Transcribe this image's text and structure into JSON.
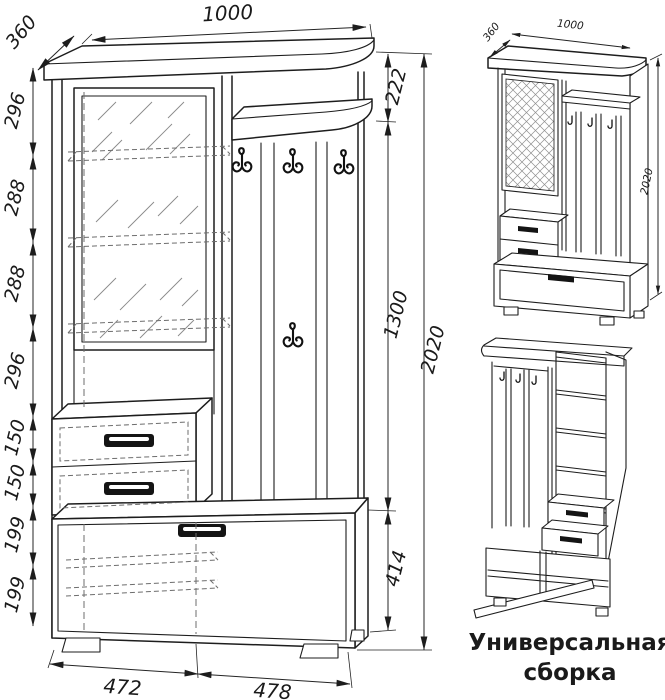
{
  "page": {
    "background": "#ffffff",
    "ink_color": "#1d1d1d"
  },
  "main_view": {
    "top_width_mm": "1000",
    "depth_mm": "360",
    "total_height_mm": "2020",
    "left_chain_mm": [
      "296",
      "288",
      "288",
      "296",
      "150",
      "150",
      "199",
      "199"
    ],
    "right_chain_mm": [
      "222",
      "1300",
      "414"
    ],
    "bottom_widths_mm": [
      "472",
      "478"
    ]
  },
  "iso_view": {
    "depth_mm": "360",
    "width_mm": "1000",
    "height_mm": "2020"
  },
  "assembly_view": {
    "caption_line1": "Универсальная",
    "caption_line2": "сборка"
  }
}
